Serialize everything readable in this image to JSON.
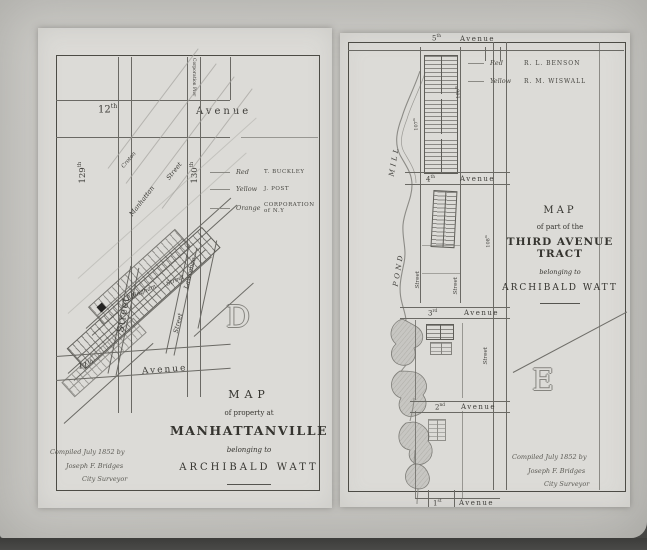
{
  "left_map": {
    "corporation_pier": "Corporation Pier",
    "avenue12": {
      "num": "12",
      "sup": "th",
      "name": "Avenue"
    },
    "avenue11": {
      "num": "11",
      "sup": "th",
      "name": "Avenue"
    },
    "street129": {
      "num": "129",
      "sup": "th"
    },
    "street130": {
      "num": "130",
      "sup": "th"
    },
    "croton": "Croton",
    "manhattan": {
      "name": "Manhattan",
      "street": "Street"
    },
    "effingham": {
      "name": "Effingham",
      "street": "Street"
    },
    "lawrence": {
      "name": "Lawrence",
      "street": "Street"
    },
    "big_street": "Street",
    "legend": [
      {
        "color": "Red",
        "name": "T. BUCKLEY"
      },
      {
        "color": "Yellow",
        "name": "J. POST"
      },
      {
        "color": "Orange",
        "name": "CORPORATION of N.Y"
      }
    ],
    "plate_letter": "D",
    "title": {
      "l1": "MAP",
      "l2": "of property at",
      "l3": "MANHATTANVILLE",
      "l4": "belonging to",
      "l5": "ARCHIBALD WATT"
    },
    "compiled": {
      "l1": "Compiled July 1852 by",
      "l2": "Joseph F. Bridges",
      "l3": "City Surveyor"
    }
  },
  "right_map": {
    "avenue5": {
      "num": "5",
      "sup": "th",
      "name": "Avenue"
    },
    "avenue4": {
      "num": "4",
      "sup": "th",
      "name": "Avenue"
    },
    "avenue3": {
      "num": "3",
      "sup": "rd",
      "name": "Avenue"
    },
    "avenue2": {
      "num": "2",
      "sup": "nd",
      "name": "Avenue"
    },
    "avenue1": {
      "num": "1",
      "sup": "st",
      "name": "Avenue"
    },
    "mill": "MILL",
    "pond": "POND",
    "street106": {
      "num": "106",
      "sup": "th"
    },
    "street107": {
      "num": "107",
      "sup": "th"
    },
    "street108": {
      "num": "108",
      "sup": "th"
    },
    "street_label_a": "Street",
    "street_label_b": "Street",
    "street_label_c": "Street",
    "legend": [
      {
        "color": "Red",
        "name": "R. L. BENSON"
      },
      {
        "color": "Yellow",
        "name": "R. M. WISWALL"
      }
    ],
    "plate_letter": "E",
    "title": {
      "l1": "MAP",
      "l2": "of part of the",
      "l3": "THIRD AVENUE TRACT",
      "l4": "belonging to",
      "l5": "ARCHIBALD WATT"
    },
    "compiled": {
      "l1": "Compiled July 1852 by",
      "l2": "Joseph F. Bridges",
      "l3": "City Surveyor"
    }
  }
}
